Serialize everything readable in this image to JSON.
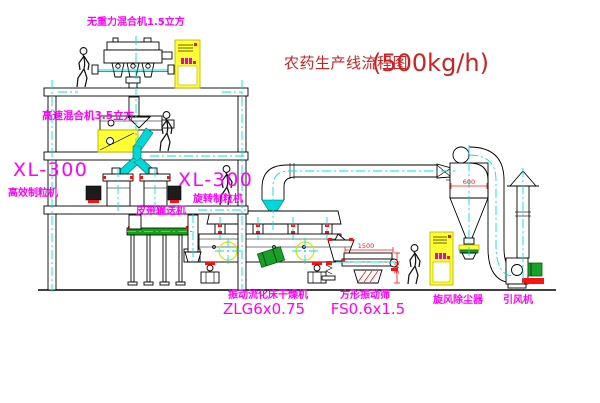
{
  "diagram": {
    "title": "农药生产线流程图",
    "capacity": "(500kg/h)",
    "floors": 3
  },
  "equipment": {
    "gravity_free_mixer": {
      "label": "无重力混合机1.5立方"
    },
    "high_speed_mixer": {
      "label": "高速混合机3.5立方"
    },
    "granulator_left": {
      "model": "XL-300",
      "name": "高效制粒机"
    },
    "granulator_right": {
      "model": "XL-300",
      "name": "旋转制粒机"
    },
    "belt_conveyor": {
      "name": "皮带输送机"
    },
    "fluid_bed_dryer": {
      "name": "振动流化床干燥机",
      "model": "ZLG6x0.75"
    },
    "square_vibrating_sieve": {
      "name": "方形振动筛",
      "model": "FS0.6x1.5",
      "dims": {
        "length": "1500",
        "height": "340"
      }
    },
    "cyclone_dust_collector": {
      "name": "旋风除尘器",
      "dims": {
        "diameter": "600"
      }
    },
    "induced_draft_fan": {
      "name": "引风机"
    }
  },
  "colors": {
    "label_magenta": "#ff00ff",
    "title_red": "#cc2222",
    "dimension_red": "#ff1111",
    "centerline_cyan": "#00e0e0",
    "highlight_yellow": "#ffff33",
    "machine_green": "#17a02a",
    "line_black": "#000000",
    "background": "#ffffff"
  }
}
